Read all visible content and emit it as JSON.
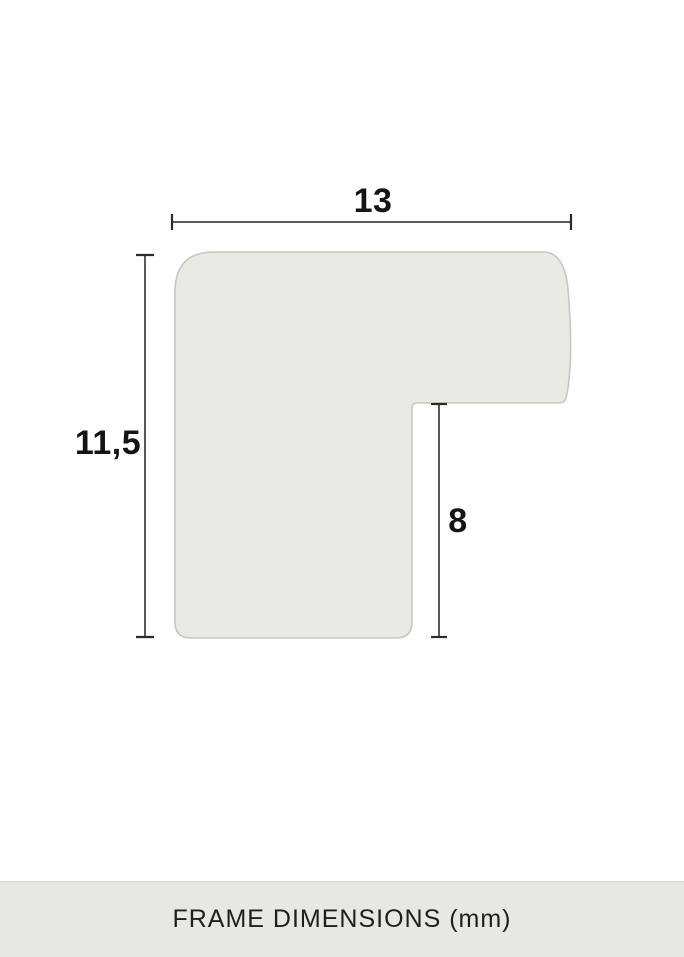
{
  "diagram": {
    "width_label": "13",
    "height_label": "11,5",
    "rabbet_label": "8"
  },
  "footer": {
    "caption": "FRAME DIMENSIONS (mm)"
  },
  "colors": {
    "background": "#ffffff",
    "profile_fill": "#e9e9e5",
    "profile_stroke": "#c7c7c2",
    "dim_line": "#5a5a5a",
    "dim_tick": "#2b2b2b",
    "label_color": "#141414",
    "footer_bg": "#e8e8e3",
    "footer_text": "#1d201c"
  }
}
